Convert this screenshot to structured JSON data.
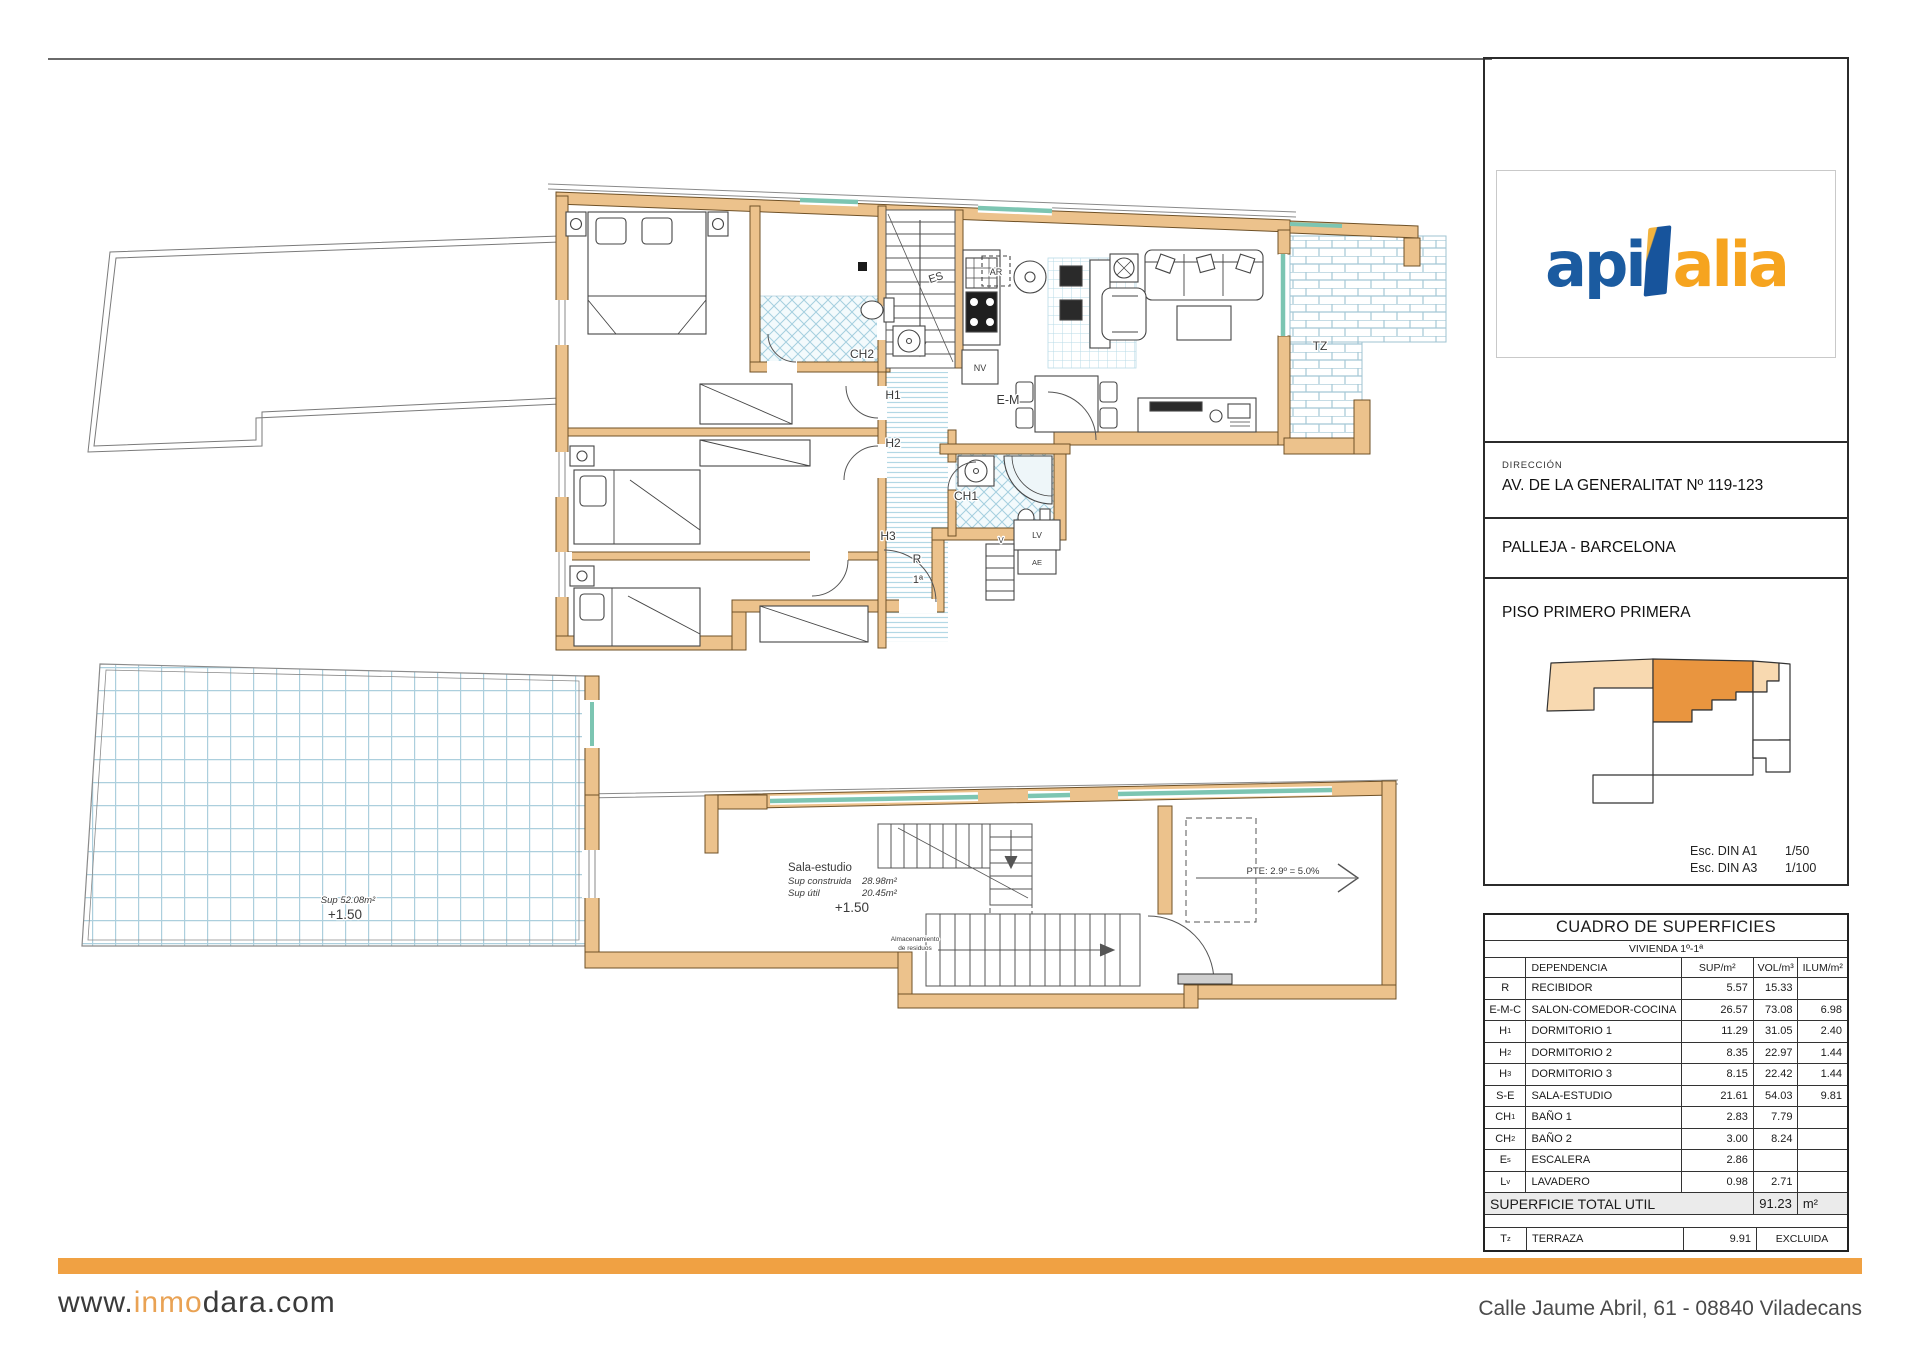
{
  "logo": {
    "blue": "api",
    "orange": "alia",
    "blue_color": "#1b5ba0",
    "orange_color": "#f6a41f"
  },
  "titleblock": {
    "direccion_label": "DIRECCIÓN",
    "direccion": "AV. DE LA GENERALITAT Nº 119-123",
    "city": "PALLEJA - BARCELONA",
    "floor": "PISO PRIMERO PRIMERA",
    "scales": [
      {
        "label": "Esc. DIN A1",
        "value": "1/50"
      },
      {
        "label": "Esc. DIN A3",
        "value": "1/100"
      }
    ],
    "minimap_colors": {
      "highlight": "#e9953f",
      "secondary": "#f8d9b0"
    }
  },
  "table": {
    "title": "CUADRO DE SUPERFICIES",
    "subtitle": "VIVIENDA 1º-1ª",
    "headers": [
      "",
      "DEPENDENCIA",
      "SUP/m²",
      "VOL/m³",
      "ILUM/m²"
    ],
    "rows": [
      {
        "code": "R",
        "sub": "",
        "name": "RECIBIDOR",
        "sup": "5.57",
        "vol": "15.33",
        "ilum": ""
      },
      {
        "code": "E-M-C",
        "sub": "",
        "name": "SALON-COMEDOR-COCINA",
        "sup": "26.57",
        "vol": "73.08",
        "ilum": "6.98"
      },
      {
        "code": "H",
        "sub": "1",
        "name": "DORMITORIO 1",
        "sup": "11.29",
        "vol": "31.05",
        "ilum": "2.40"
      },
      {
        "code": "H",
        "sub": "2",
        "name": "DORMITORIO 2",
        "sup": "8.35",
        "vol": "22.97",
        "ilum": "1.44"
      },
      {
        "code": "H",
        "sub": "3",
        "name": "DORMITORIO 3",
        "sup": "8.15",
        "vol": "22.42",
        "ilum": "1.44"
      },
      {
        "code": "S-E",
        "sub": "",
        "name": "SALA-ESTUDIO",
        "sup": "21.61",
        "vol": "54.03",
        "ilum": "9.81"
      },
      {
        "code": "CH",
        "sub": "1",
        "name": "BAÑO 1",
        "sup": "2.83",
        "vol": "7.79",
        "ilum": ""
      },
      {
        "code": "CH",
        "sub": "2",
        "name": "BAÑO 2",
        "sup": "3.00",
        "vol": "8.24",
        "ilum": ""
      },
      {
        "code": "E",
        "sub": "s",
        "name": "ESCALERA",
        "sup": "2.86",
        "vol": "",
        "ilum": ""
      },
      {
        "code": "L",
        "sub": "v",
        "name": "LAVADERO",
        "sup": "0.98",
        "vol": "2.71",
        "ilum": ""
      }
    ],
    "total": {
      "label": "SUPERFICIE TOTAL UTIL",
      "value": "91.23",
      "unit": "m²"
    },
    "terrace": {
      "code": "T",
      "sub": "z",
      "name": "TERRAZA",
      "sup": "9.91",
      "note": "EXCLUIDA"
    }
  },
  "plans": {
    "upper": {
      "ch2": "CH2",
      "es": "ES",
      "h1": "H1",
      "h2": "H2",
      "h3": "H3",
      "ch1": "CH1",
      "r": "R",
      "door_no": "1ª",
      "v": "V",
      "lv": "LV",
      "ae": "AE",
      "nv": "NV",
      "ar": "AR",
      "em": "E-M",
      "tz": "TZ"
    },
    "lower": {
      "room": "Sala-estudio",
      "sup_built_label": "Sup construida",
      "sup_built": "28.98m²",
      "sup_util_label": "Sup útil",
      "sup_util": "20.45m²",
      "level": "+1.50",
      "storage_l1": "Almacenamiento",
      "storage_l2": "de residuos",
      "terrace_sup": "Sup 52.08m²",
      "terrace_level": "+1.50",
      "slope": "PTE: 2.9º = 5.0%"
    }
  },
  "footer": {
    "site_pre": "www.",
    "site_mid": "inmo",
    "site_post": "dara.com",
    "address": "Calle Jaume Abril, 61 - 08840 Viladecans",
    "bar_color": "#f0a143"
  }
}
